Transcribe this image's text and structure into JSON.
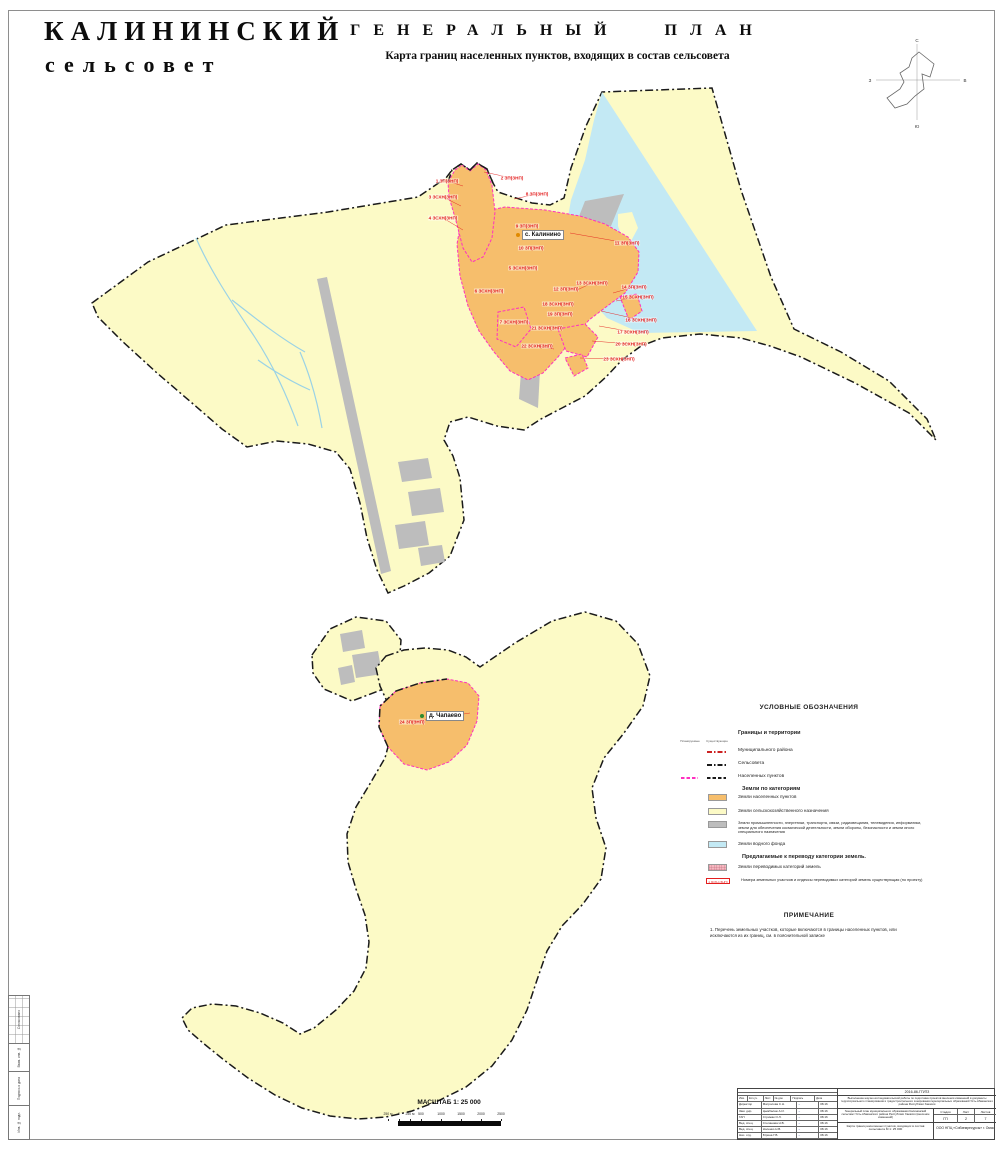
{
  "header": {
    "title_line1": "КАЛИНИНСКИЙ",
    "title_line2": "сельсовет",
    "main_title": "ГЕНЕРАЛЬНЫЙ ПЛАН",
    "subtitle": "Карта границ населенных пунктов, входящих в состав сельсовета"
  },
  "compass": {
    "north": "С",
    "south": "Ю",
    "west": "З",
    "east": "В"
  },
  "map": {
    "settlements": [
      {
        "name": "с. Калинино",
        "x": 516,
        "y": 235,
        "dot_color": "#e08a00"
      },
      {
        "name": "д. Чапаево",
        "x": 420,
        "y": 716,
        "dot_color": "#2e8b2e"
      }
    ],
    "labels": [
      {
        "text": "1 ЗП(ЗНП)",
        "x": 447,
        "y": 181,
        "tx": 463,
        "ty": 186
      },
      {
        "text": "2 ЗП(ЗНП)",
        "x": 512,
        "y": 178,
        "tx": 484,
        "ty": 172
      },
      {
        "text": "3 ЗСХН(ЗНП)",
        "x": 443,
        "y": 197,
        "tx": 461,
        "ty": 206
      },
      {
        "text": "4 ЗСХН(ЗНП)",
        "x": 443,
        "y": 218,
        "tx": 463,
        "ty": 230
      },
      {
        "text": "5 ЗСХН(ЗНП)",
        "x": 523,
        "y": 268
      },
      {
        "text": "6 ЗСХН(ЗНП)",
        "x": 489,
        "y": 291
      },
      {
        "text": "7 ЗСХН(ЗНП)",
        "x": 514,
        "y": 322
      },
      {
        "text": "8 ЗП(ЗНП)",
        "x": 537,
        "y": 194,
        "tx": 514,
        "ty": 199
      },
      {
        "text": "9 ЗП(ЗНП)",
        "x": 527,
        "y": 226
      },
      {
        "text": "10 ЗП(ЗНП)",
        "x": 531,
        "y": 248
      },
      {
        "text": "11 ЗП(ЗНП)",
        "x": 627,
        "y": 243,
        "tx": 570,
        "ty": 233
      },
      {
        "text": "12 ЗП(ЗНП)",
        "x": 566,
        "y": 289
      },
      {
        "text": "13 ЗСХН(ЗНП)",
        "x": 592,
        "y": 283,
        "tx": 575,
        "ty": 291
      },
      {
        "text": "14 ЗП(ЗНП)",
        "x": 634,
        "y": 287,
        "tx": 613,
        "ty": 293
      },
      {
        "text": "15 ЗСХН(ЗНП)",
        "x": 638,
        "y": 297,
        "tx": 616,
        "ty": 301
      },
      {
        "text": "16 ЗСХН(ЗНП)",
        "x": 641,
        "y": 320,
        "tx": 601,
        "ty": 311
      },
      {
        "text": "17 ЗСХН(ЗНП)",
        "x": 633,
        "y": 332,
        "tx": 599,
        "ty": 326
      },
      {
        "text": "18 ЗСХН(ЗНП)",
        "x": 558,
        "y": 304
      },
      {
        "text": "19 ЗП(ЗНП)",
        "x": 560,
        "y": 314
      },
      {
        "text": "20 ЗСХН(ЗНП)",
        "x": 631,
        "y": 344,
        "tx": 592,
        "ty": 341
      },
      {
        "text": "21 ЗСХН(ЗНП)",
        "x": 547,
        "y": 328
      },
      {
        "text": "22 ЗСХН(ЗНП)",
        "x": 537,
        "y": 346,
        "tx": 554,
        "ty": 349
      },
      {
        "text": "23 ЗСХН(ЗНП)",
        "x": 619,
        "y": 359,
        "tx": 580,
        "ty": 358
      },
      {
        "text": "24 ЗП(ЗНП)",
        "x": 412,
        "y": 722,
        "tx": 470,
        "ty": 713
      }
    ]
  },
  "legend": {
    "title": "УСЛОВНЫЕ ОБОЗНАЧЕНИЯ",
    "col_planned": "Планируемые",
    "col_existing": "Существующие",
    "boundaries": {
      "heading": "Границы и территории",
      "rows": [
        {
          "label": "Муниципального района",
          "samples": [
            {
              "col": "e",
              "style": "dashdot",
              "color": "#cc2222"
            }
          ]
        },
        {
          "label": "Сельсовета",
          "samples": [
            {
              "col": "e",
              "style": "dashdot",
              "color": "#1a1a1a"
            }
          ]
        },
        {
          "label": "Населенных пунктов",
          "samples": [
            {
              "col": "p",
              "style": "dash",
              "color": "#FF30C0"
            },
            {
              "col": "e",
              "style": "dash",
              "color": "#1a1a1a"
            }
          ]
        }
      ]
    },
    "categories": {
      "heading": "Земли по категориям",
      "rows": [
        {
          "color": "#F6BE6C",
          "label": "Земли населенных пунктов"
        },
        {
          "color": "#FCFAC6",
          "label": "Земли сельскохозяйственного назначения"
        },
        {
          "color": "#BDBDBD",
          "label": "Земли промышленности, энергетики, транспорта, связи, радиовещания, телевидения, информатики, земли для обеспечения космической деятельности, земли обороны, безопасности и земли иного специального назначения"
        },
        {
          "color": "#C3E9F4",
          "label": "Земли водного фонда"
        }
      ]
    },
    "transfer": {
      "heading": "Предлагаемые к переводу категории земель.",
      "swatch_row": {
        "color": "#F5B8C0",
        "label": "Земли переводимых категорий земель"
      },
      "code_row": {
        "code": "1 ЗСХН (ЗНП)",
        "label": "Номера земельных участков и индексы переводимых категорий земель существующая (по проекту)"
      }
    }
  },
  "note": {
    "title": "ПРИМЕЧАНИЕ",
    "text": "1. Перечень земельных участков, которые включаются в границы населенных пунктов, или исключаются из их границ, см. в пояснительной записке"
  },
  "scale": {
    "title": "МАСШТАБ 1: 25 000",
    "ticks": [
      {
        "label": "250 м",
        "x": 5
      },
      {
        "label": "0",
        "x": 16
      },
      {
        "label": "250 м",
        "x": 27
      },
      {
        "label": "500",
        "x": 38
      },
      {
        "label": "1000",
        "x": 58
      },
      {
        "label": "1500",
        "x": 78
      },
      {
        "label": "2000",
        "x": 98
      },
      {
        "label": "2500",
        "x": 118
      }
    ]
  },
  "stamp": {
    "doc_number": "2016-86-ГП/ПЗ",
    "project": "Выполнение научно-исследовательской работы по подготовке проектов внесения изменений в документы территориального планирования и градостроительного зонирования муниципальных образований Усть-Абаканского района Республики Хакасия",
    "object": "Генеральный план муниципального образования Калининский сельсовет Усть-Абаканского района Республики Хакасия (внесение изменений)",
    "stage_label": "Стадия",
    "sheet_label": "Лист",
    "sheets_label": "Листов",
    "stage": "ГП",
    "sheet": "2",
    "sheets": "7",
    "sheet_title": "Карта границ населенных пунктов, входящих в состав сельсовета М 1: 25 000",
    "org": "ООО НПЦ «Сибземресурсы» г. Омск",
    "table_header": [
      "Изм.",
      "Кол.уч.",
      "Лист",
      "№ док.",
      "Подпись",
      "Дата"
    ],
    "signatures": [
      {
        "role": "Директор",
        "name": "Матросова С.Н.",
        "date": "08.16"
      },
      {
        "role": "Зам. дир.",
        "name": "Цымбалюк А.И.",
        "date": "08.16"
      },
      {
        "role": "ГАП",
        "name": "Стрижак О.Л.",
        "date": "08.16"
      },
      {
        "role": "Вед. спец.",
        "name": "Степанова Н.В.",
        "date": "08.16"
      },
      {
        "role": "Вед. спец.",
        "name": "Носенко Н.В.",
        "date": "08.16"
      },
      {
        "role": "Нач. отд.",
        "name": "Юрина Г.В.",
        "date": "08.16"
      }
    ]
  },
  "side_stamp": {
    "labels": [
      "Согласовано",
      "Взам. инв. №",
      "Подпись и дата",
      "Инв. № подл."
    ]
  },
  "colors": {
    "agricultural": "#FCFAC6",
    "settlement": "#F6BE6C",
    "industrial": "#BDBDBD",
    "water": "#C3E9F4",
    "transfer_pink": "#F5B8C0",
    "settlement_boundary": "#FF30C0",
    "municipal_boundary": "#1a1a1a",
    "label_red": "#E31E1E"
  }
}
